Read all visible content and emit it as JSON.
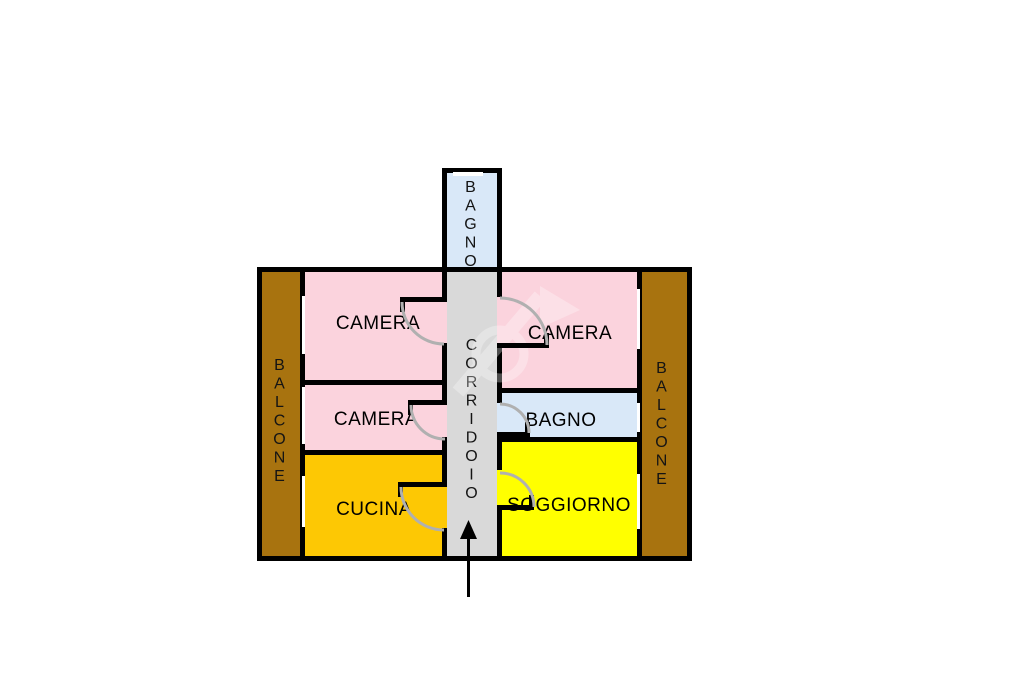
{
  "floor_plan": {
    "type": "apartment floor plan (planimetria)",
    "rooms": {
      "bagno_top": {
        "label": "BAGNO",
        "color": "#D9E8F8"
      },
      "camera_top_left": {
        "label": "CAMERA",
        "color": "#FBD3DD"
      },
      "camera_mid_left": {
        "label": "CAMERA",
        "color": "#FBD3DD"
      },
      "cucina": {
        "label": "CUCINA",
        "color": "#FDC804"
      },
      "camera_top_right": {
        "label": "CAMERA",
        "color": "#FBD3DD"
      },
      "bagno_right": {
        "label": "BAGNO",
        "color": "#D9E8F8"
      },
      "soggiorno": {
        "label": "SOGGIORNO",
        "color": "#FFFF00"
      },
      "corridoio": {
        "label": "CORRIDOIO",
        "color": "#D9D9D9"
      },
      "balcone_left": {
        "label": "BALCONE",
        "color": "#A8730F"
      },
      "balcone_right": {
        "label": "BALCONE",
        "color": "#A8730F"
      }
    },
    "icons": {
      "entrance_arrow": "arrow-up-entrance",
      "door_swings": "quarter-circle-door-arcs",
      "windows": "white-slit-window-symbols",
      "watermark": "faint-flag-logo-watermark"
    },
    "colors": {
      "wall": "#000000",
      "background": "#FFFFFF",
      "door_arc": "#B0B0B0"
    }
  }
}
